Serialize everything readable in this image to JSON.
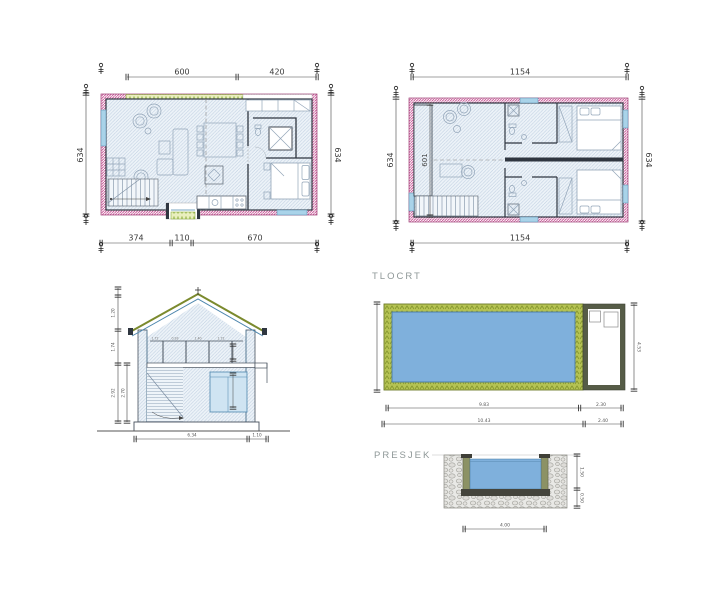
{
  "drawing_labels": {
    "pool_plan": "TLOCRT",
    "pool_section": "PRESJEK"
  },
  "ground_floor_plan": {
    "dim_top_left": "600",
    "dim_top_right": "420",
    "dim_side_left": "634",
    "dim_side_right": "634",
    "dim_bottom_1": "374",
    "dim_bottom_2": "110",
    "dim_bottom_3": "670"
  },
  "upper_floor_plan": {
    "dim_top": "1154",
    "dim_bottom": "1154",
    "dim_side_left": "634",
    "dim_side_right": "634",
    "dim_inner_width": "601"
  },
  "house_section": {
    "dim_roof_height": "1.20",
    "dim_upper_floor": "1.74",
    "dim_ground_floor": "2.92",
    "dim_ground_inner": "2.70",
    "dim_width": "6.34",
    "dim_overhang": "1.10",
    "dim_bay_1": "1.72",
    "dim_bay_2": "0.93",
    "dim_bay_3": "1.40",
    "dim_bay_4": "1.72"
  },
  "pool_plan": {
    "dim_basin_length": "9.83",
    "dim_tech_room": "2.30",
    "dim_total_length": "10.43",
    "dim_tech_outer": "2.40",
    "dim_width": "4.53"
  },
  "pool_section": {
    "dim_depth": "1.50",
    "dim_base": "0.50",
    "dim_width": "4.00"
  },
  "colors": {
    "water_blue": "#7fb0dc",
    "pool_surround_green": "#b5c353",
    "terrace_green": "#e9efbe",
    "insulation_pink": "#c4498e",
    "window_blue": "#a9d3e9",
    "wall_dark": "#2f3640",
    "tech_room_wall": "#565c47",
    "roof_green": "#7b8a2e",
    "stone_gray": "#e9e9e6"
  }
}
